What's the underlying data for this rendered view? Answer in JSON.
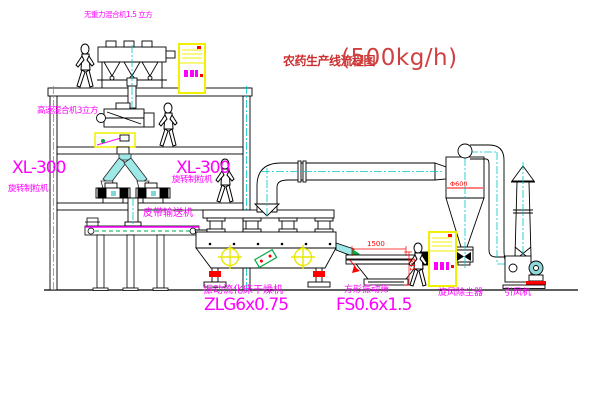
{
  "title": {
    "text": "农药生产线流程图",
    "capacity": "(500kg/h)"
  },
  "equipment_labels": {
    "gravity_mixer": "无重力混合机1.5 立方",
    "high_speed_mixer": "高速混合机3立方",
    "granulator_left": {
      "model": "XL-300",
      "name": "旋转制粒机"
    },
    "granulator_right": {
      "model": "XL-300",
      "name": "旋转制粒机"
    },
    "belt_conveyor": "皮带输送机",
    "dryer": {
      "name": "振动流化床干燥机",
      "model": "ZLG6x0.75"
    },
    "sieve": {
      "name": "方形振动筛",
      "model": "FS0.6x1.5"
    },
    "cyclone": "旋风除尘器",
    "fan": "引风机"
  },
  "dimensions": {
    "sieve_length": "1500",
    "sieve_height": "541",
    "cyclone_diameter": "Φ600"
  },
  "colors": {
    "outline": "#000000",
    "centerline": "#00c8c8",
    "label_magenta": "#ff00ff",
    "title_red": "#cc3030",
    "dimension_red": "#ff0000",
    "cabinet_yellow": "#f0f000",
    "chute_cyan": "#9fe8e8",
    "highlight_green": "#00aa44"
  }
}
